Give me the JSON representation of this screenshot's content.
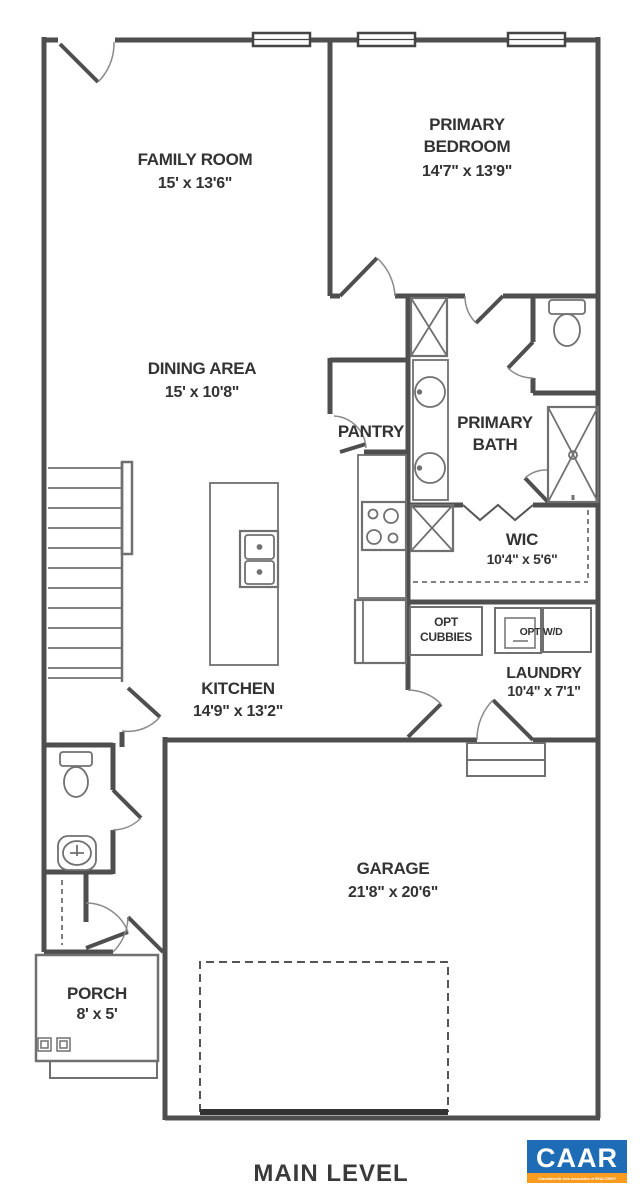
{
  "title": "MAIN LEVEL",
  "rooms": {
    "family_room": {
      "name": "FAMILY ROOM",
      "dims": "15' x 13'6\""
    },
    "primary_bedroom": {
      "line1": "PRIMARY",
      "line2": "BEDROOM",
      "dims": "14'7\" x 13'9\""
    },
    "dining": {
      "name": "DINING AREA",
      "dims": "15' x 10'8\""
    },
    "pantry": {
      "name": "PANTRY"
    },
    "primary_bath": {
      "line1": "PRIMARY",
      "line2": "BATH"
    },
    "wic": {
      "name": "WIC",
      "dims": "10'4\" x 5'6\""
    },
    "laundry": {
      "name": "LAUNDRY",
      "dims": "10'4\" x 7'1\""
    },
    "kitchen": {
      "name": "KITCHEN",
      "dims": "14'9\" x 13'2\""
    },
    "garage": {
      "name": "GARAGE",
      "dims": "21'8\" x 20'6\""
    },
    "porch": {
      "name": "PORCH",
      "dims": "8' x 5'"
    }
  },
  "features": {
    "opt_cubbies": {
      "line1": "OPT",
      "line2": "CUBBIES"
    },
    "opt_wd": {
      "label": "OPT W/D"
    }
  },
  "logo": {
    "text": "CAAR",
    "tagline": "Charlottesville Area Association of REALTORS®"
  },
  "colors": {
    "logo_blue": "#1e6cb5",
    "logo_orange": "#f89b1e",
    "wall": "#4f4f4f"
  }
}
